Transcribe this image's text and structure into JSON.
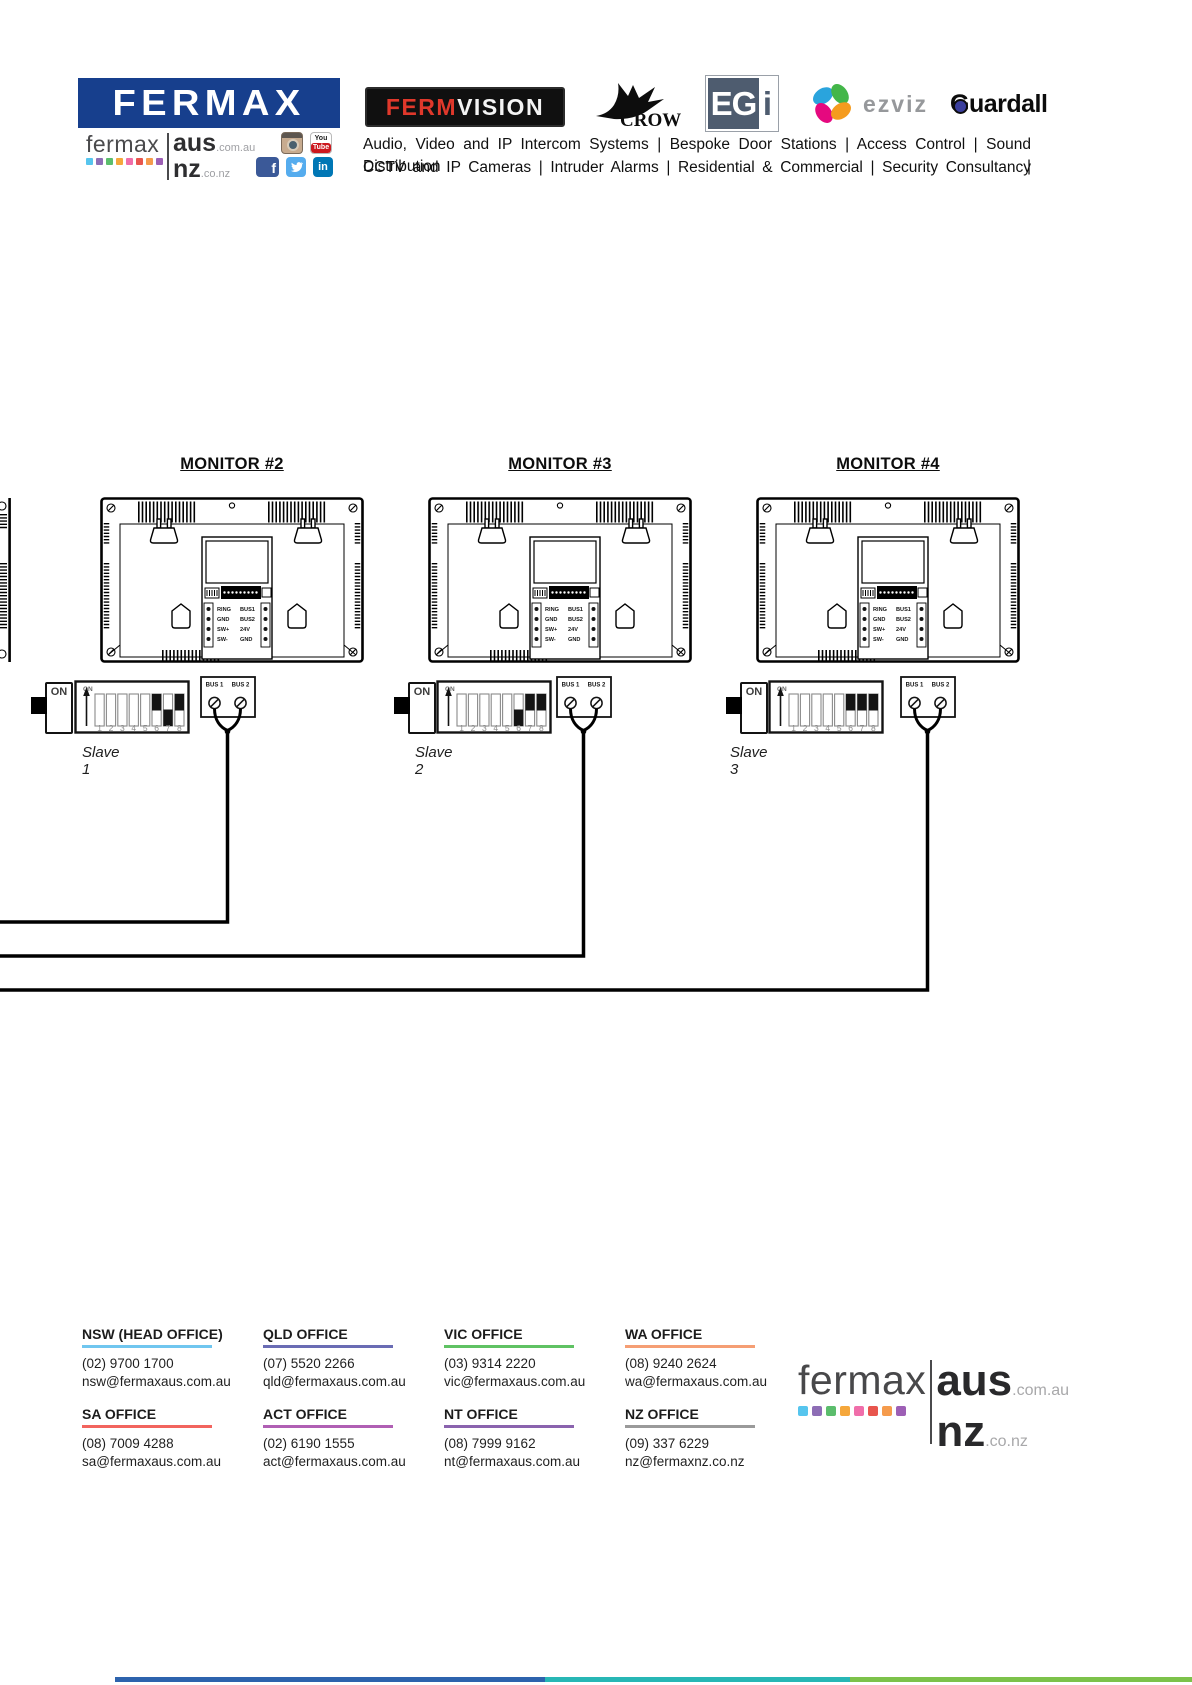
{
  "header": {
    "fermax_box_label": "FERMAX",
    "fermax_box_color": "#173f8d",
    "fermaxaus_logo": {
      "fermax": "fermax",
      "aus": "aus",
      "aus_tld": ".com.au",
      "nz": "nz",
      "nz_tld": ".co.nz",
      "squares": [
        "#56c5ee",
        "#8d6db5",
        "#5bbd6c",
        "#f5a73b",
        "#f06eaa",
        "#e8554d",
        "#f59b4c",
        "#9d5fb5"
      ]
    },
    "partner_logos": {
      "fermvision_ferm": "FERM",
      "fermvision_vision": "VISION",
      "crow": "CROW",
      "egi_main": "EG",
      "egi_i": "i",
      "ezviz": "ezviz",
      "guardall": "Guardall"
    },
    "social_glyphs": {
      "youtube_top": "You",
      "youtube_bottom": "Tube",
      "facebook": "f",
      "linkedin": "in"
    },
    "tagline_line1": "Audio, Video and IP Intercom Systems | Bespoke Door Stations | Access Control | Sound Distribution |",
    "tagline_line2": "CCTV and IP Cameras | Intruder Alarms | Residential & Commercial | Security Consultancy"
  },
  "diagram": {
    "dip_on_label": "ON",
    "switch_on_label": "ON",
    "dip_numbers": [
      "1",
      "2",
      "3",
      "4",
      "5",
      "6",
      "7",
      "8"
    ],
    "bus_label_1": "BUS 1",
    "bus_label_2": "BUS 2",
    "connector": {
      "left_labels": [
        "RING",
        "GND",
        "SW+",
        "SW-"
      ],
      "right_labels": [
        "BUS1",
        "BUS2",
        "24V",
        "GND"
      ]
    },
    "monitors": [
      {
        "title": "MONITOR #2",
        "slave": "Slave 1",
        "dip_states": [
          "none",
          "none",
          "none",
          "none",
          "none",
          "up",
          "down",
          "up"
        ]
      },
      {
        "title": "MONITOR #3",
        "slave": "Slave 2",
        "dip_states": [
          "none",
          "none",
          "none",
          "none",
          "none",
          "down",
          "up",
          "up"
        ]
      },
      {
        "title": "MONITOR #4",
        "slave": "Slave 3",
        "dip_states": [
          "none",
          "none",
          "none",
          "none",
          "none",
          "up",
          "up",
          "up"
        ]
      }
    ]
  },
  "footer": {
    "offices": [
      {
        "name": "NSW (HEAD OFFICE)",
        "phone": "(02) 9700 1700",
        "email": "nsw@fermaxaus.com.au",
        "color": "#70c6ef"
      },
      {
        "name": "QLD OFFICE",
        "phone": "(07) 5520 2266",
        "email": "qld@fermaxaus.com.au",
        "color": "#6a6cb4"
      },
      {
        "name": "VIC OFFICE",
        "phone": "(03) 9314 2220",
        "email": "vic@fermaxaus.com.au",
        "color": "#5fc263"
      },
      {
        "name": "WA OFFICE",
        "phone": "(08) 9240 2624",
        "email": "wa@fermaxaus.com.au",
        "color": "#f59e74"
      },
      {
        "name": "SA OFFICE",
        "phone": "(08) 7009 4288",
        "email": "sa@fermaxaus.com.au",
        "color": "#f2645e"
      },
      {
        "name": "ACT OFFICE",
        "phone": "(02) 6190 1555",
        "email": "act@fermaxaus.com.au",
        "color": "#b05fb4"
      },
      {
        "name": "NT OFFICE",
        "phone": "(08) 7999 9162",
        "email": "nt@fermaxaus.com.au",
        "color": "#8a63ae"
      },
      {
        "name": "NZ OFFICE",
        "phone": "(09) 337 6229",
        "email": "nz@fermaxnz.co.nz",
        "color": "#9a9a9a"
      }
    ],
    "logo": {
      "fermax": "fermax",
      "aus": "aus",
      "aus_tld": ".com.au",
      "nz": "nz",
      "nz_tld": ".co.nz",
      "squares": [
        "#56c5ee",
        "#8d6db5",
        "#5bbd6c",
        "#f5a73b",
        "#f06eaa",
        "#e8554d",
        "#f59b4c",
        "#9d5fb5"
      ]
    },
    "bottom_bar_colors": [
      "#2d63ad",
      "#27b7b5",
      "#7cc24a"
    ]
  }
}
